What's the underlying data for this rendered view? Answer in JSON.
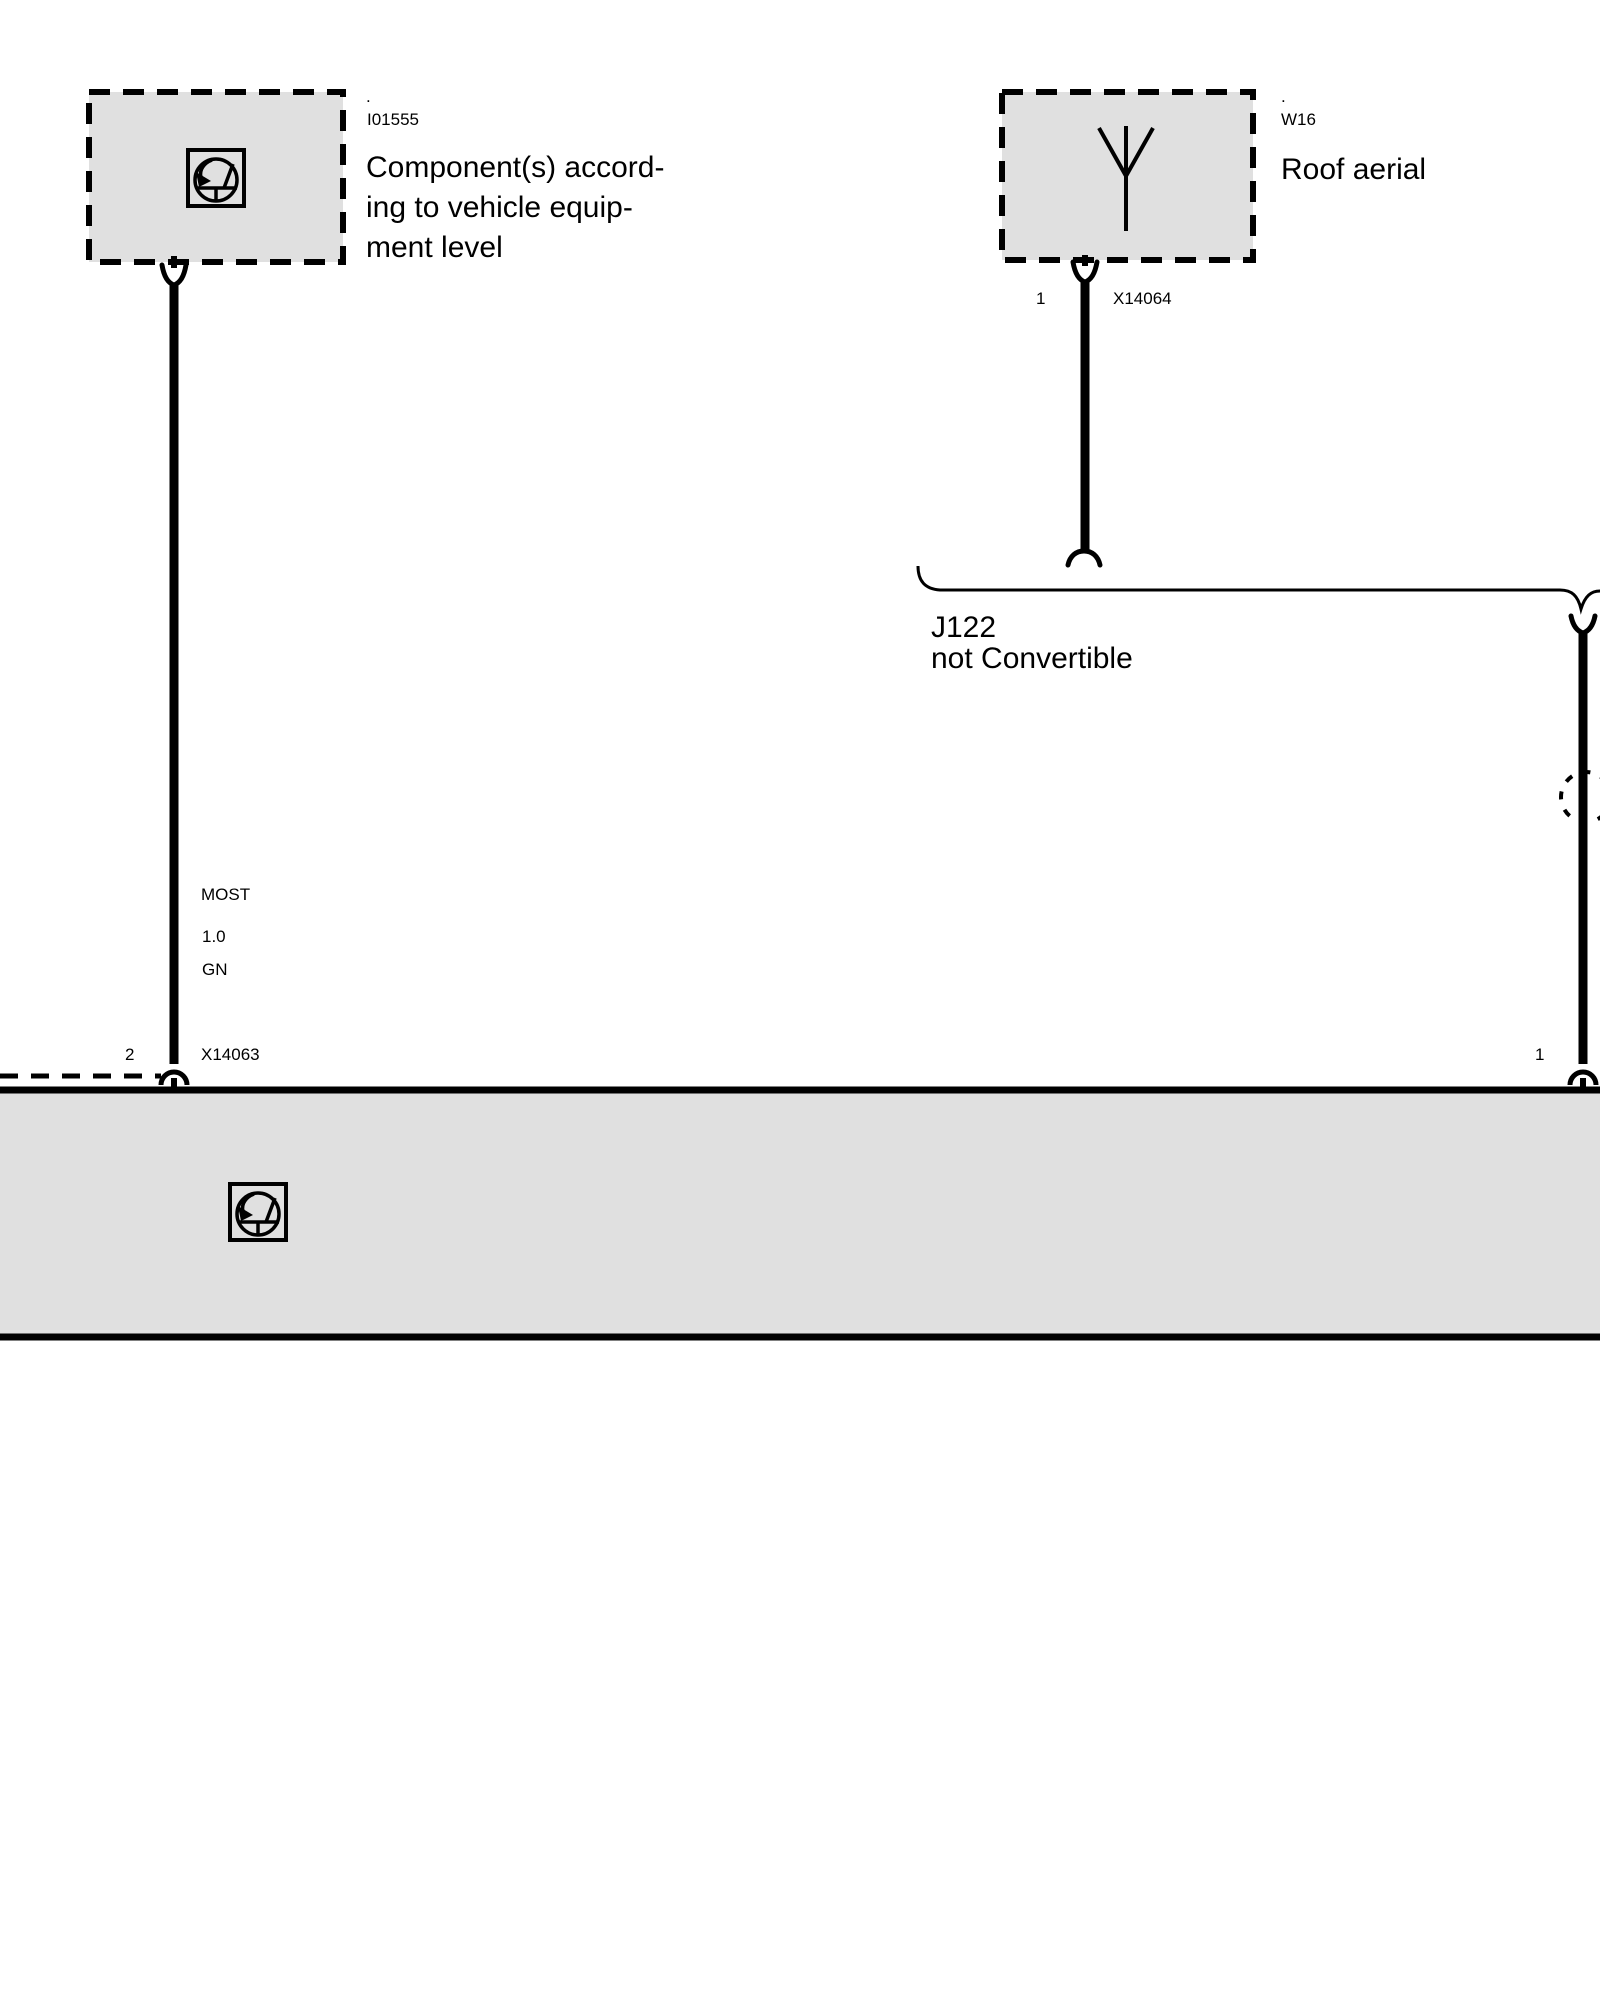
{
  "diagram": {
    "optional_component": {
      "dot": ".",
      "code": "I01555",
      "label": "Component(s) accord-\ning to vehicle equip-\nment level"
    },
    "roof_aerial": {
      "dot": ".",
      "code": "W16",
      "label": "Roof aerial"
    },
    "bracket": {
      "code": "J122",
      "condition": "not Convertible"
    },
    "most_wire": {
      "bus": "MOST",
      "cross_section": "1.0",
      "color_code": "GN",
      "pin": "2",
      "connector": "X14063"
    },
    "aerial_wire": {
      "pin": "1",
      "connector": "X14064"
    },
    "right_wire": {
      "pin": "1"
    },
    "colors": {
      "box_fill": "#e0e0e0",
      "line": "#000000"
    }
  }
}
